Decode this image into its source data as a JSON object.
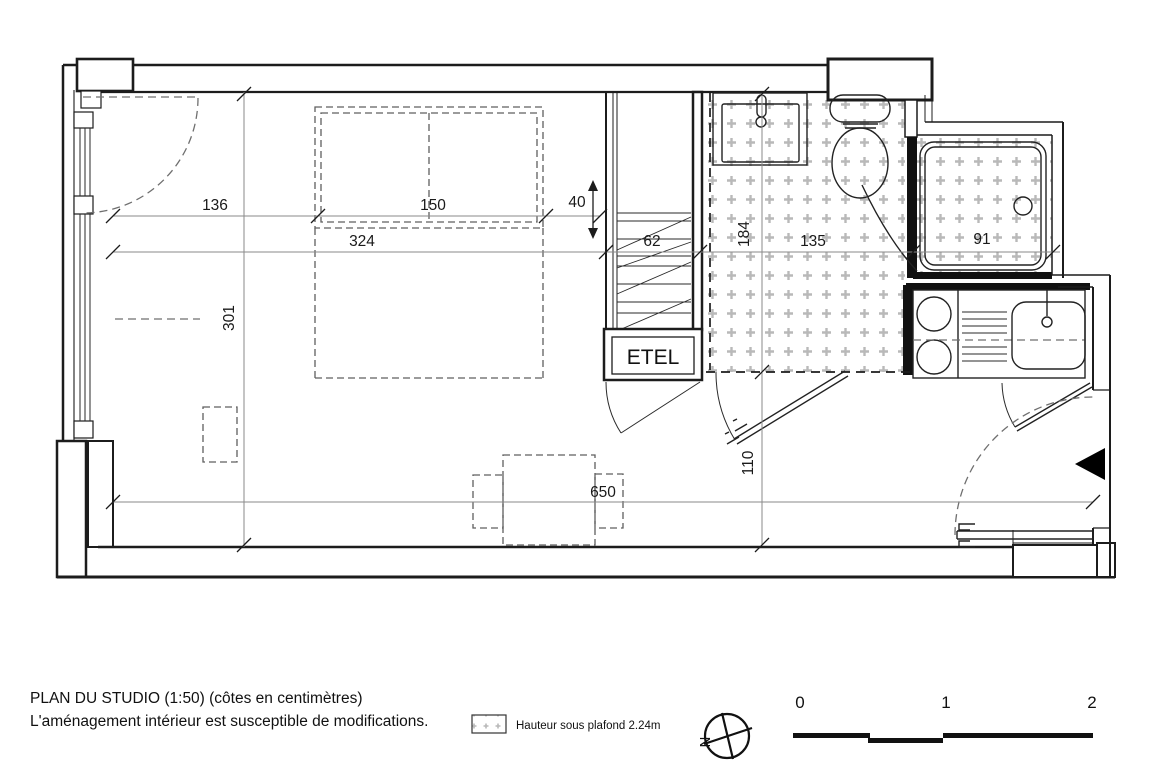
{
  "title_block": {
    "line1": "PLAN DU STUDIO (1:50) (côtes en centimètres)",
    "line2": "L'aménagement intérieur est susceptible de modifications."
  },
  "legend": {
    "label": "Hauteur sous plafond 2.24m"
  },
  "compass": {
    "north_label": "N"
  },
  "scale_bar": {
    "tick0": "0",
    "tick1": "1",
    "tick2": "2"
  },
  "plan": {
    "cabinet_label": "ETEL",
    "dimensions": {
      "window_wall": "136",
      "bed_width": "150",
      "bed_gap": "40",
      "room_width_lower": "324",
      "closet_depth": "62",
      "bathroom_length": "184",
      "bathroom_width": "135",
      "shower_width": "91",
      "room_depth": "301",
      "total_length": "650",
      "entry_depth": "110"
    },
    "colors": {
      "wall_line": "#1c1c1c",
      "hatch": "#b9b9b9",
      "dim_line": "#8a8a8a",
      "furniture_dash": "#5f5f5f"
    }
  }
}
